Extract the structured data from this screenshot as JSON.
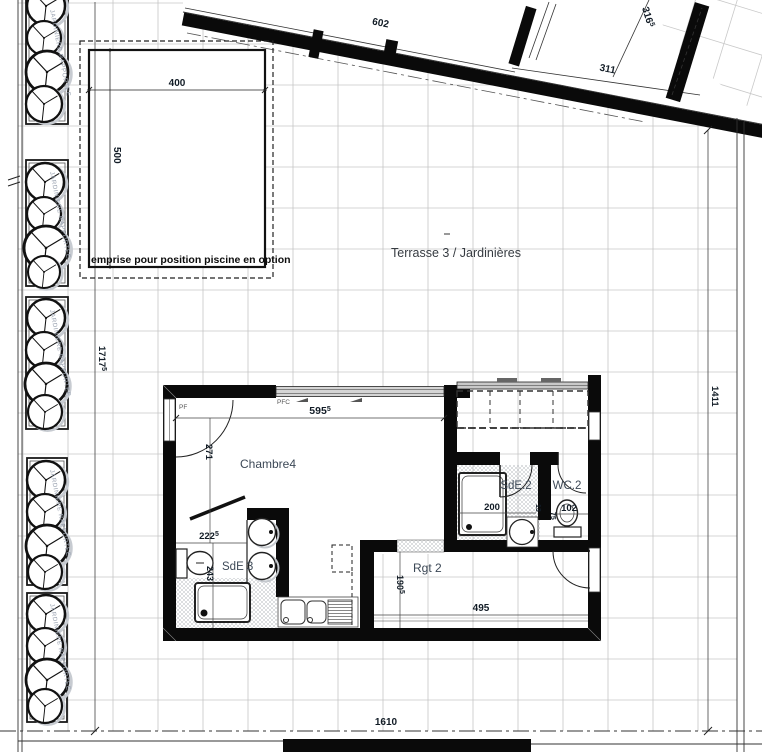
{
  "colors": {
    "wall": "#0a0a0a",
    "grid_line": "#c6c6c6",
    "dim_text": "#121c26",
    "room_text": "#3c4856",
    "muted_text": "#99a2b0",
    "glass_fill": "#d5d5d5"
  },
  "annotations": {
    "terrace_label": "Terrasse 3 / Jardinières",
    "pool_label": "emprise pour position piscine en option",
    "planter_label": "JARDINIERE RAPPORTEE",
    "window_left": "PF",
    "window_top": "PFC"
  },
  "rooms": {
    "bedroom": "Chambre4",
    "shower_room_3": "SdE 3",
    "shower_room_2": "SdE.2",
    "wc_2": "WC.2",
    "storage_2": "Rgt 2"
  },
  "dims": {
    "d602": "602",
    "d311": "311",
    "d316": {
      "v": "316",
      "sup": "5"
    },
    "d400": "400",
    "d500": "500",
    "d1717": {
      "v": "1717",
      "sup": "5"
    },
    "d1411": "1411",
    "d1610": "1610",
    "d595": {
      "v": "595",
      "sup": "5"
    },
    "d271": "271",
    "d222": {
      "v": "222",
      "sup": "5"
    },
    "d243": "243",
    "d200": "200",
    "d102": "102",
    "d75": "75",
    "d13": "13",
    "d190": {
      "v": "190",
      "sup": "5"
    },
    "d495": "495"
  }
}
